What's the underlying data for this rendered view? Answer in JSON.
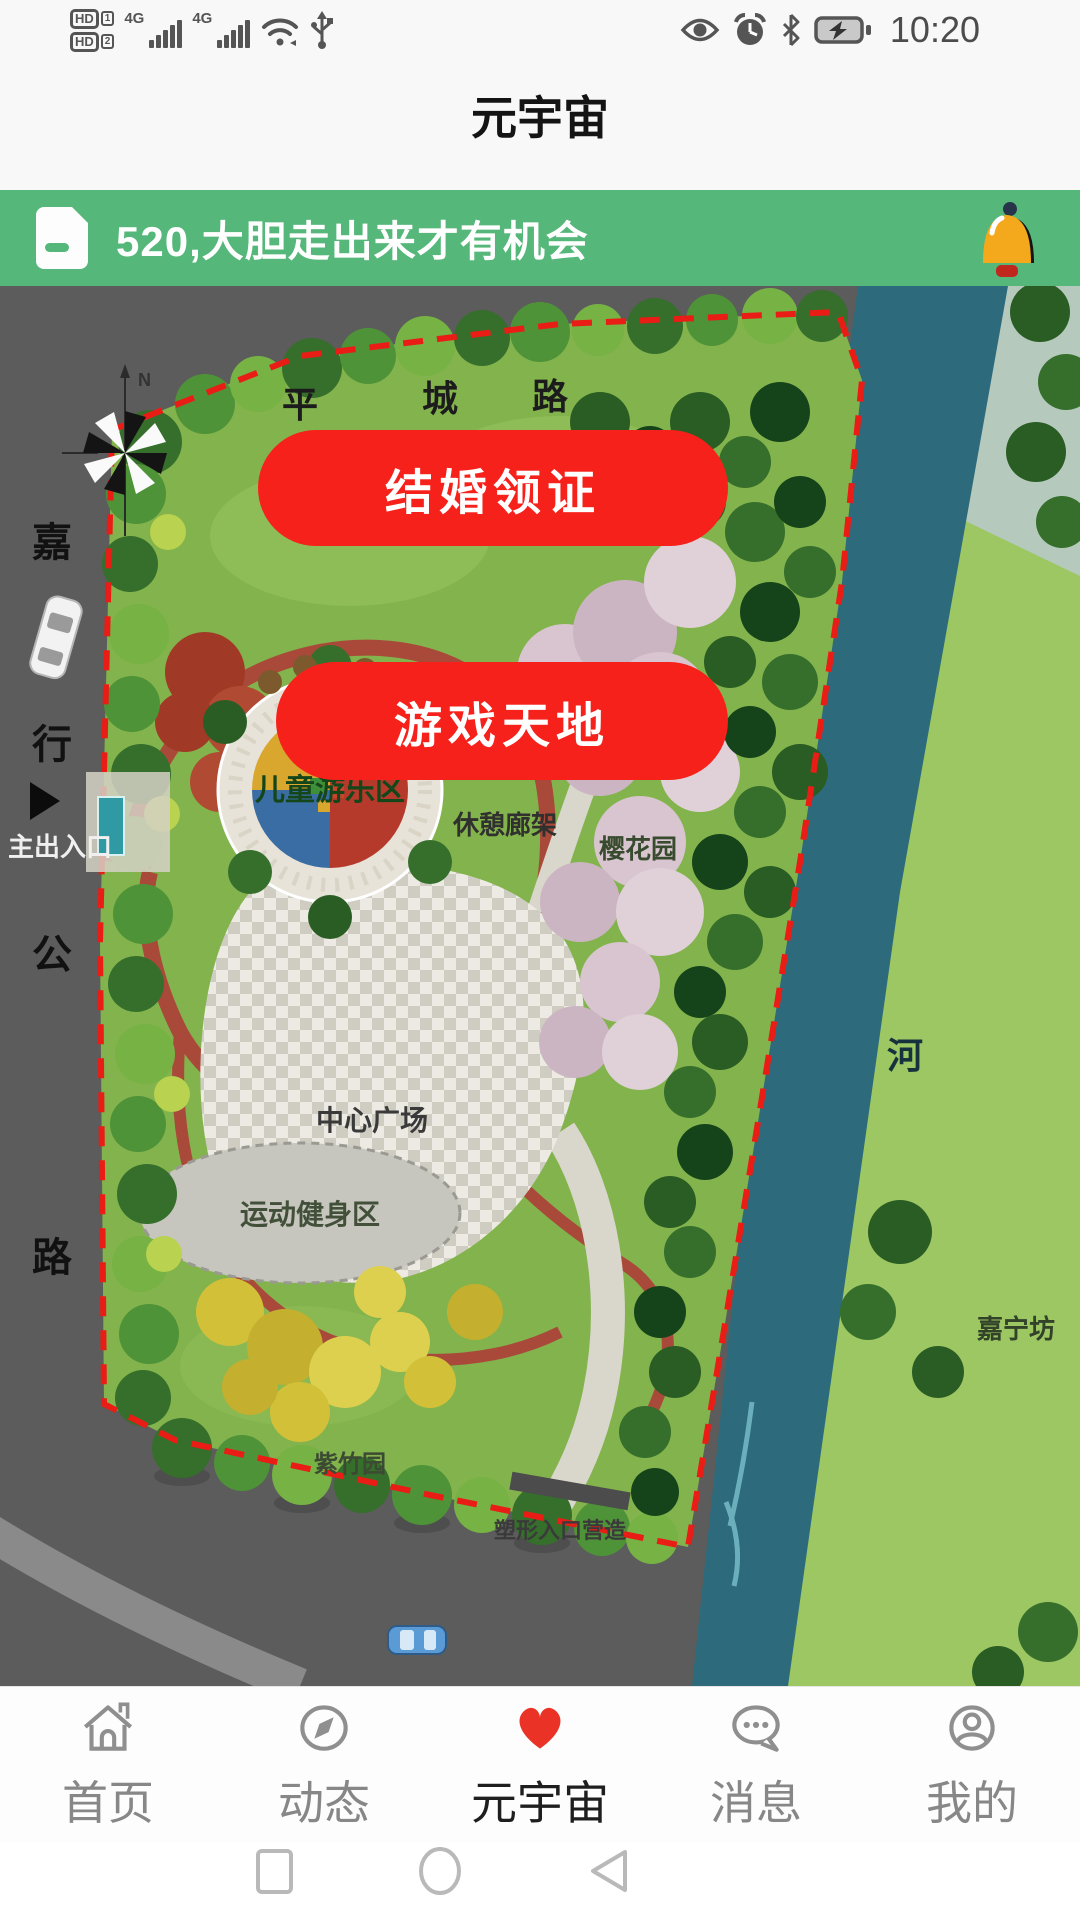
{
  "status_bar": {
    "time": "10:20",
    "hd_label": "HD",
    "hd_slots": [
      "1",
      "2"
    ],
    "network_label": "4G",
    "icons_left": [
      "hd1-icon",
      "hd2-icon",
      "signal-icon",
      "signal-icon",
      "wifi-icon",
      "usb-icon"
    ],
    "icons_right": [
      "eye-icon",
      "alarm-icon",
      "bluetooth-icon",
      "battery-charging-icon"
    ]
  },
  "header": {
    "title": "元宇宙"
  },
  "banner": {
    "text": "520,大胆走出来才有机会",
    "bg_color": "#55b87a",
    "icons": [
      "document-icon",
      "bell-icon"
    ]
  },
  "map": {
    "buttons": [
      {
        "label": "结婚领证"
      },
      {
        "label": "游戏天地"
      }
    ],
    "button_color": "#f6211a",
    "labels": {
      "road_top_1": "平",
      "road_top_2": "城",
      "road_top_3": "路",
      "road_left_1": "嘉",
      "road_left_2": "行",
      "road_left_3": "公",
      "road_left_4": "路",
      "north": "N",
      "main_entrance": "主出入口",
      "children_play_area": "儿童游乐区",
      "rest_pergola": "休憩廊架",
      "cherry_blossom_garden": "樱花园",
      "central_plaza": "中心广场",
      "sports_fitness_area": "运动健身区",
      "purple_bamboo_garden": "紫竹园",
      "shaped_entrance": "塑形入口营造",
      "river": "河",
      "jianing_fang": "嘉宁坊"
    },
    "colors": {
      "park_green": "#83b34c",
      "river": "#2d6a7c",
      "road": "#5c5c5c",
      "boundary_red": "#ea1c16"
    }
  },
  "tab_bar": {
    "items": [
      {
        "label": "首页",
        "icon": "home-icon",
        "active": false
      },
      {
        "label": "动态",
        "icon": "compass-icon",
        "active": false
      },
      {
        "label": "元宇宙",
        "icon": "heart-icon",
        "active": true
      },
      {
        "label": "消息",
        "icon": "message-icon",
        "active": false
      },
      {
        "label": "我的",
        "icon": "profile-icon",
        "active": false
      }
    ],
    "active_color": "#1e1e1e",
    "inactive_color": "#878787",
    "heart_color": "#ea3326"
  },
  "android_nav": {
    "icons": [
      "recents-square-icon",
      "home-circle-icon",
      "back-triangle-icon"
    ]
  }
}
